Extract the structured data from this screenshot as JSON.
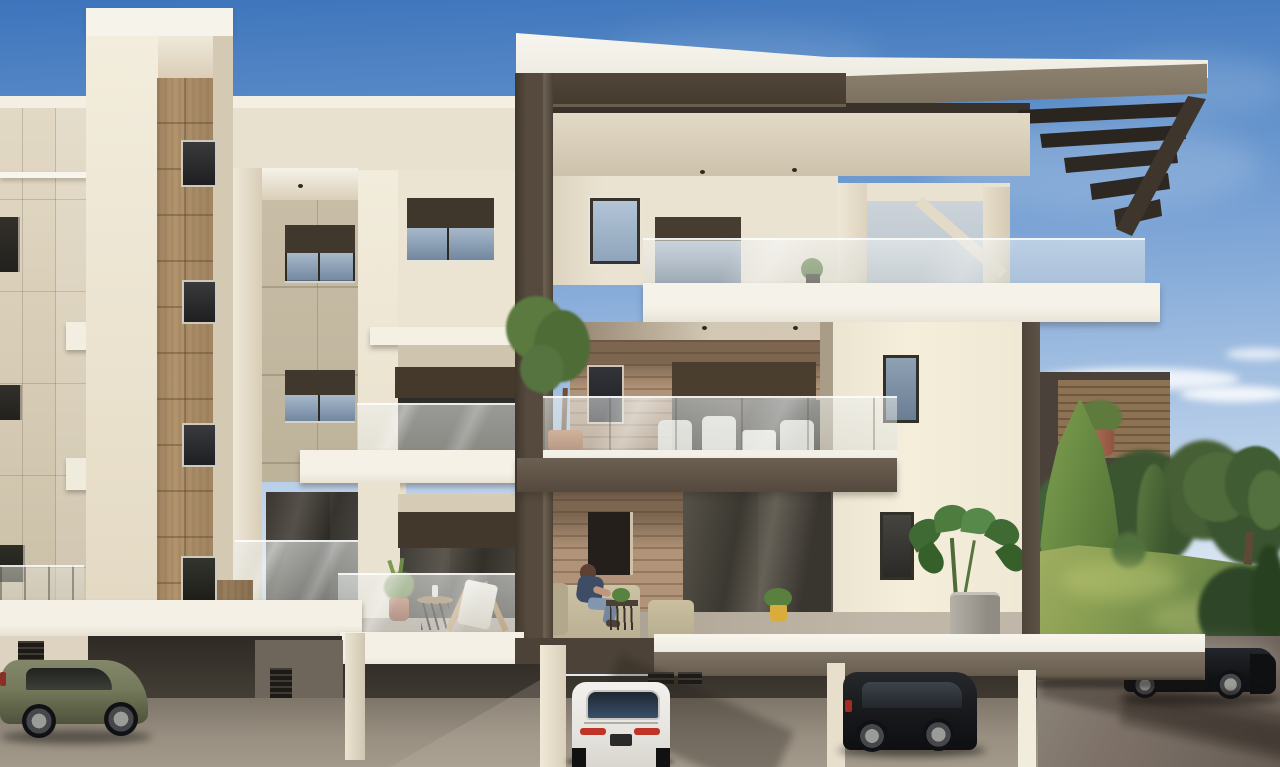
{
  "scene": {
    "type": "3d-architectural-exterior-render",
    "description": "Daytime photorealistic rendering of a modern three-storey apartment building: cream stucco volumes framed by a large dark taupe concrete frame, timber panel accents, glass balcony railings, roof overhang with exposed dark joists, open ground-level parking with cars beneath, a resident seated on a ground-floor terrace sofa, and trees with a sunlit lawn on the right under a blue sky with thin clouds.",
    "sky": {
      "zenith": "#3d74bb",
      "mid": "#86abd9",
      "horizon": "#d7e3f2",
      "clouds": "#ffffff"
    },
    "landscape": {
      "items": [
        "pine-tree",
        "cypress-tree",
        "tree-line",
        "large-tree",
        "shrub",
        "lawn",
        "hedge"
      ],
      "lawn_light": "#9caf62",
      "lawn_dark": "#5c7540",
      "tree_dark": "#3a5530",
      "tree_light": "#7fa04f"
    },
    "building": {
      "storeys": 3,
      "parking": "open pilotis parking under the building",
      "materials": {
        "stucco_lit": "#f2ecdc",
        "stucco": "#e7dfcd",
        "stucco_shadow": "#d7cdb6",
        "panel_greige": "#c6bba4",
        "frame_taupe": "#50463a",
        "roof_fascia": "#8a7e6d",
        "soffit": "#3a332b",
        "timber": "#b2946e",
        "plank_wall": "#b09378",
        "window_glass": "#8ba0b8",
        "roller_blind": "#42392d",
        "slab_white": "#f4f0e5",
        "railing_glass": "#dfe3e0",
        "terrace_floor": "#b5ab9d",
        "asphalt": "#8f867a"
      },
      "features": [
        "roof overhang with exposed dark joists",
        "recessed balconies",
        "glass balustrades",
        "timber stair-core strip with four windows",
        "wood-clad terrace walls",
        "roller blinds over glazing"
      ]
    },
    "vehicles": [
      {
        "name": "olive-suv",
        "color": "#787c5d",
        "location": "parked left under the building"
      },
      {
        "name": "white-sports-car",
        "color": "#eceae6",
        "location": "parked centre under the building, rear view"
      },
      {
        "name": "black-suv",
        "color": "#17191c",
        "location": "parked centre-right under the building"
      },
      {
        "name": "black-car",
        "color": "#141619",
        "location": "driveway right, partly hidden behind terrace slab"
      }
    ],
    "people": [
      {
        "name": "seated-person",
        "location": "ground-floor terrace sofa",
        "shirt": "#3e4c66",
        "jeans": "#7e91a8",
        "hair": "#5f4133"
      }
    ],
    "plants": [
      {
        "name": "monstera-in-grey-pot",
        "location": "ground-floor terrace right"
      },
      {
        "name": "small-tree-in-terracotta-pot",
        "location": "second-floor balcony"
      },
      {
        "name": "aloe-in-terracotta-pot",
        "location": "first-floor terrace"
      },
      {
        "name": "plant-in-yellow-pot",
        "location": "ground-floor terrace"
      },
      {
        "name": "plant-in-terracotta-pot",
        "location": "upper-right balcony"
      },
      {
        "name": "small-plant",
        "location": "penthouse balcony edge"
      }
    ],
    "furniture": [
      "beige-sectional-sofa",
      "beige-armchair",
      "dark-coffee-table",
      "wooden-deck-chair",
      "round-side-table",
      "white-outdoor-dining-set"
    ]
  }
}
